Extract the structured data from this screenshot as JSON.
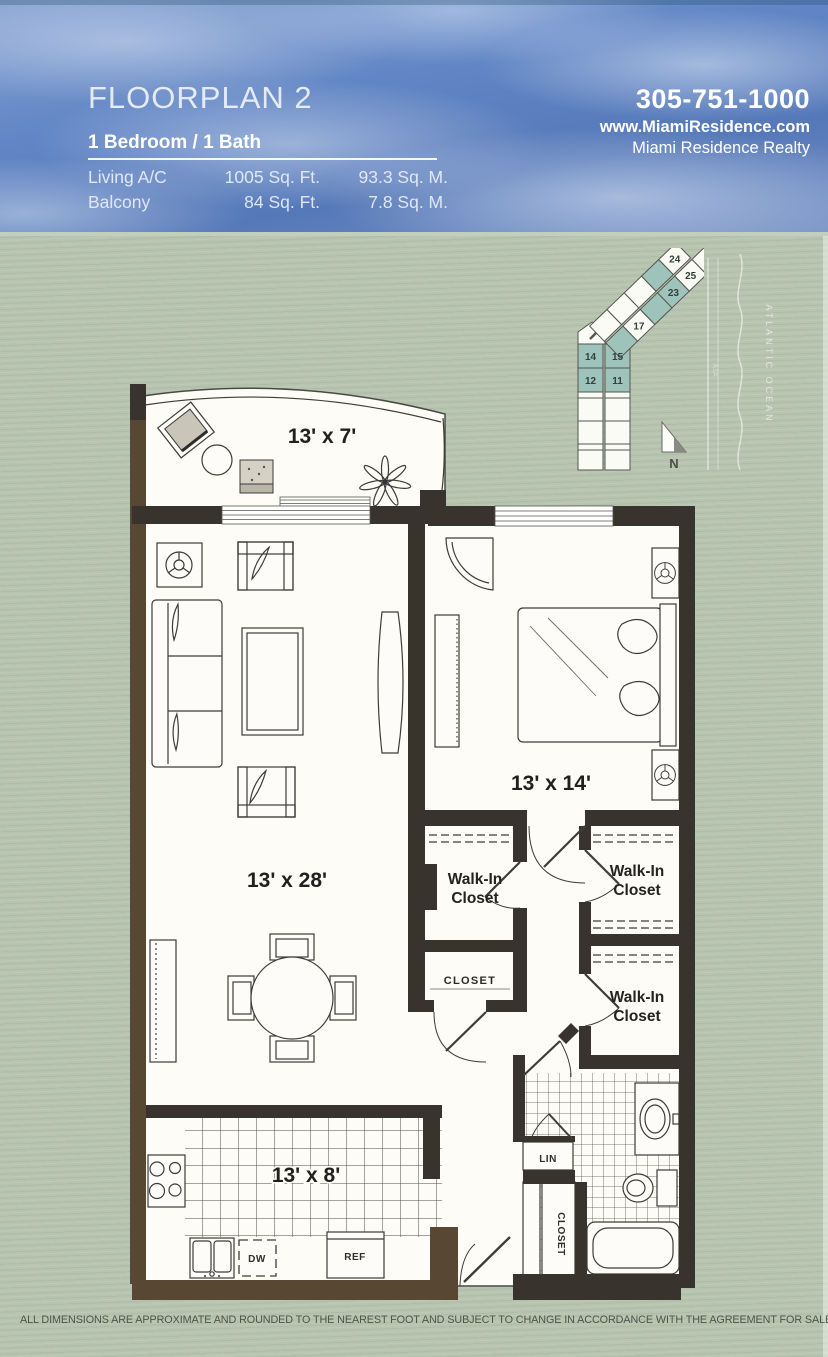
{
  "header": {
    "title": "FLOORPLAN 2",
    "subtitle": "1 Bedroom / 1 Bath",
    "areas": [
      {
        "label": "Living A/C",
        "sqft": "1005 Sq. Ft.",
        "sqm": "93.3 Sq. M."
      },
      {
        "label": "Balcony",
        "sqft": "84 Sq. Ft.",
        "sqm": "7.8 Sq. M."
      }
    ],
    "phone": "305-751-1000",
    "website": "www.MiamiResidence.com",
    "company": "Miami Residence Realty"
  },
  "floorplan": {
    "balcony_dim": "13' x 7'",
    "living_dim": "13' x 28'",
    "bedroom_dim": "13' x 14'",
    "kitchen_dim": "13' x 8'",
    "walkin_line1": "Walk-In",
    "walkin_line2": "Closet",
    "closet": "CLOSET",
    "lin": "LIN",
    "closet_vertical": "CLOSET",
    "dw": "DW",
    "ref": "REF"
  },
  "keyplan": {
    "units": {
      "u24": "24",
      "u25": "25",
      "u23": "23",
      "u17": "17",
      "u14": "14",
      "u15": "15",
      "u12": "12",
      "u11": "11"
    },
    "north": "N",
    "ocean": "ATLANTIC OCEAN",
    "road": "A1A"
  },
  "footer": {
    "disclaimer": "ALL DIMENSIONS ARE APPROXIMATE AND ROUNDED TO THE NEAREST FOOT AND SUBJECT TO CHANGE IN ACCORDANCE WITH THE AGREEMENT FOR SALE."
  },
  "colors": {
    "wall": "#38332d",
    "wall_brown": "#584732",
    "unit_highlight": "#9dc3ba",
    "header_blue": "#6286c5",
    "background": "#b7c4b0"
  }
}
